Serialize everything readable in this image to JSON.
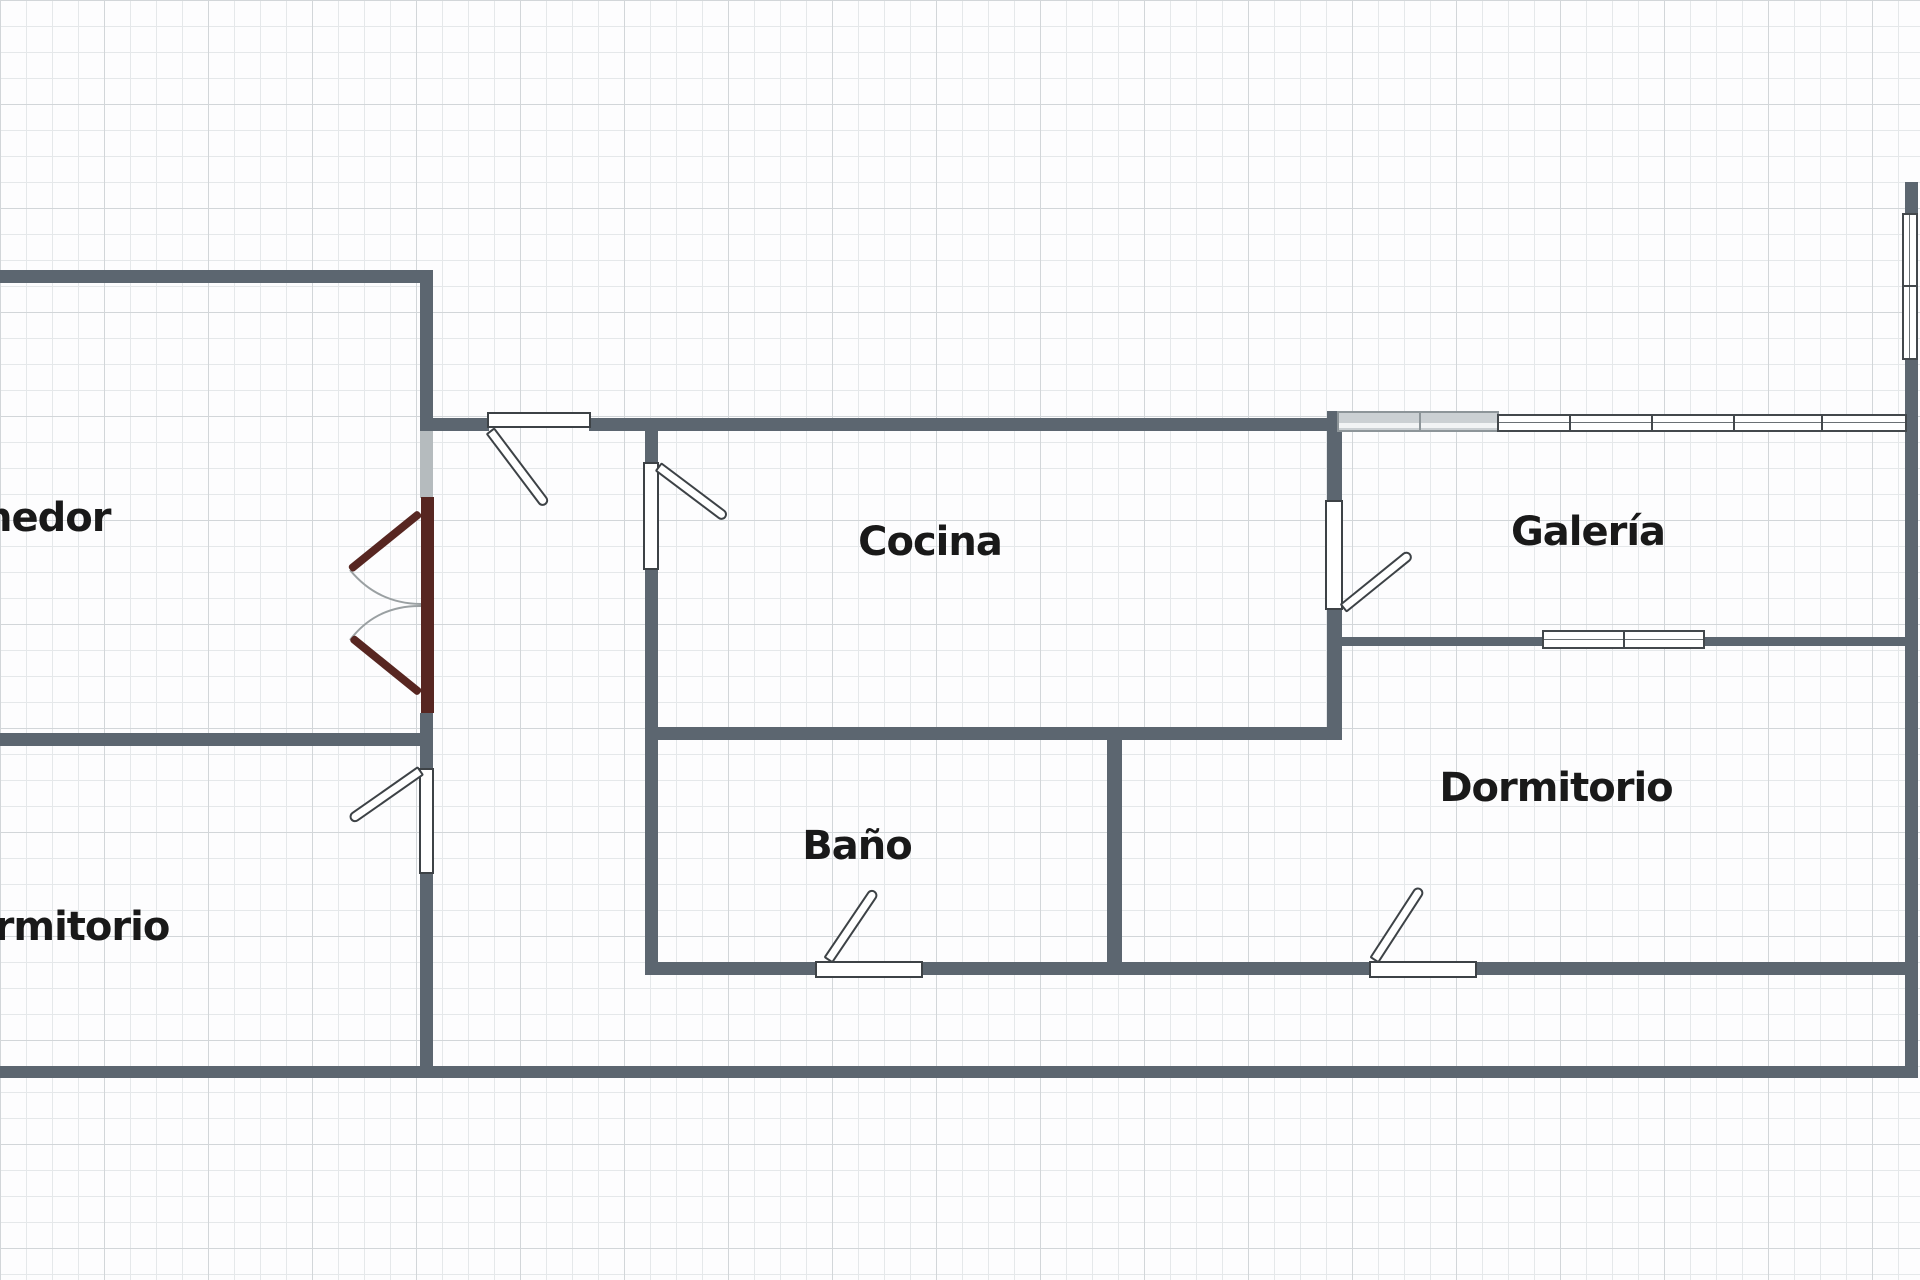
{
  "rooms": [
    {
      "id": "comedor",
      "label": "Comedor"
    },
    {
      "id": "cocina",
      "label": "Cocina"
    },
    {
      "id": "galeria",
      "label": "Galería"
    },
    {
      "id": "dormitorio-derecha",
      "label": "Dormitorio"
    },
    {
      "id": "bano",
      "label": "Baño"
    },
    {
      "id": "dormitorio-izquierda",
      "label": "Dormitorio"
    }
  ],
  "colors": {
    "wall": "#5c6670",
    "door_accent": "#572621",
    "window_gray": "#cbd0d3",
    "label": "#191919",
    "grid_line": "#e5e8ea",
    "grid_major": "#d2d6d9",
    "background": "#fdfdfe"
  }
}
